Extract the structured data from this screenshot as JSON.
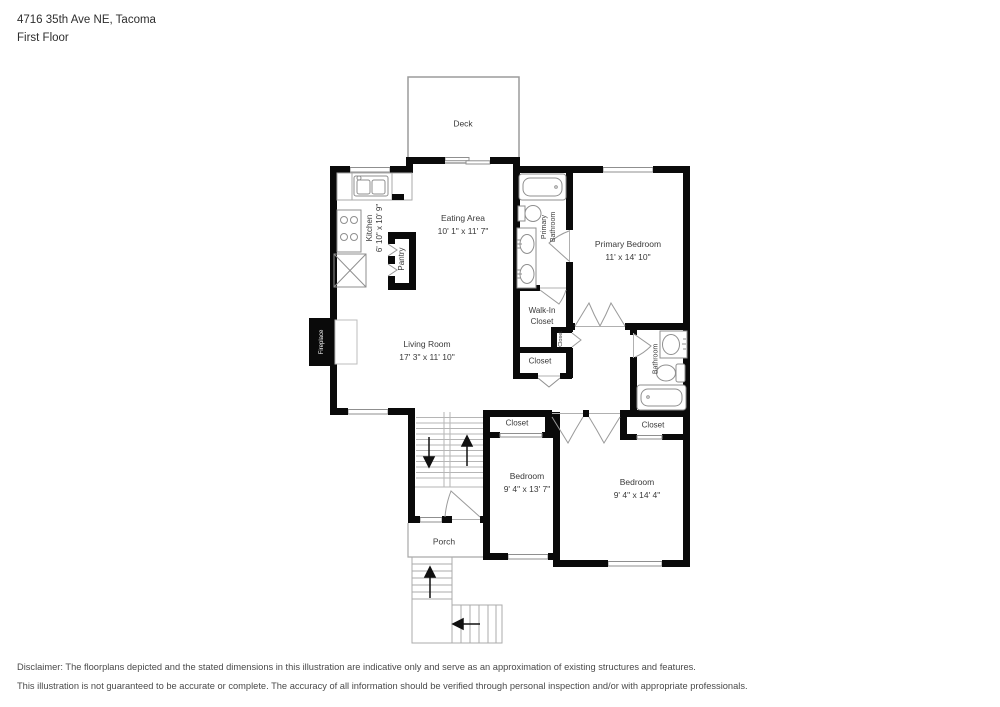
{
  "header": {
    "address": "4716 35th Ave NE, Tacoma",
    "floor": "First Floor"
  },
  "rooms": {
    "deck": {
      "label": "Deck"
    },
    "eating_area": {
      "label": "Eating Area",
      "dims": "10' 1\" x 11' 7\""
    },
    "kitchen": {
      "label": "Kitchen",
      "dims": "6' 10\" x 10' 9\""
    },
    "pantry": {
      "label": "Pantry"
    },
    "living_room": {
      "label": "Living Room",
      "dims": "17' 3\" x 11' 10\""
    },
    "fireplace": {
      "label": "Fireplace"
    },
    "primary_bedroom": {
      "label": "Primary Bedroom",
      "dims": "11' x 14' 10\""
    },
    "primary_bathroom": {
      "label": "Primary",
      "label2": "Bathroom"
    },
    "walk_in_closet": {
      "label": "Walk-In",
      "label2": "Closet"
    },
    "closet_inner": {
      "label": "Closet"
    },
    "closet_hall": {
      "label": "Closet"
    },
    "bathroom": {
      "label": "Bathroom"
    },
    "closet_left": {
      "label": "Closet"
    },
    "closet_right": {
      "label": "Closet"
    },
    "bedroom_left": {
      "label": "Bedroom",
      "dims": "9' 4\" x 13' 7\""
    },
    "bedroom_right": {
      "label": "Bedroom",
      "dims": "9' 4\" x 14' 4\""
    },
    "porch": {
      "label": "Porch"
    }
  },
  "disclaimer": {
    "line1": "Disclaimer: The floorplans depicted and the stated dimensions in this illustration are indicative only and serve as an approximation of existing structures and features.",
    "line2": "This illustration is not guaranteed to be accurate or complete. The accuracy of all information should be verified through personal inspection and/or with appropriate professionals."
  },
  "colors": {
    "wall": "#0a0a0a",
    "fixture_line": "#8f8f8f",
    "stair_line": "#b5b5b5",
    "text": "#3a3a3a"
  }
}
